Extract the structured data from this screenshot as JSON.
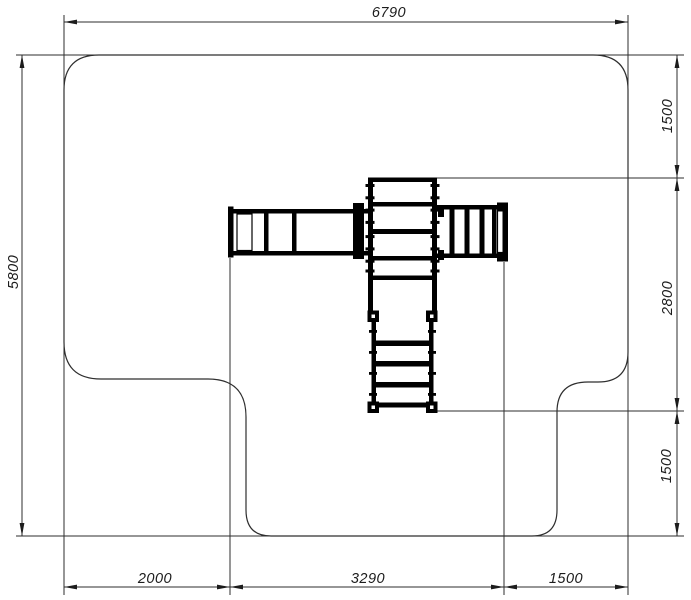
{
  "drawing": {
    "kind": "playground-equipment-plan-view",
    "dims": {
      "overall_width": "6790",
      "overall_height": "5800",
      "right_top_offset": "1500",
      "equipment_depth": "2800",
      "right_bottom_offset": "1500",
      "bottom_left_offset": "2000",
      "equipment_width": "3290",
      "bottom_right_offset": "1500"
    }
  }
}
